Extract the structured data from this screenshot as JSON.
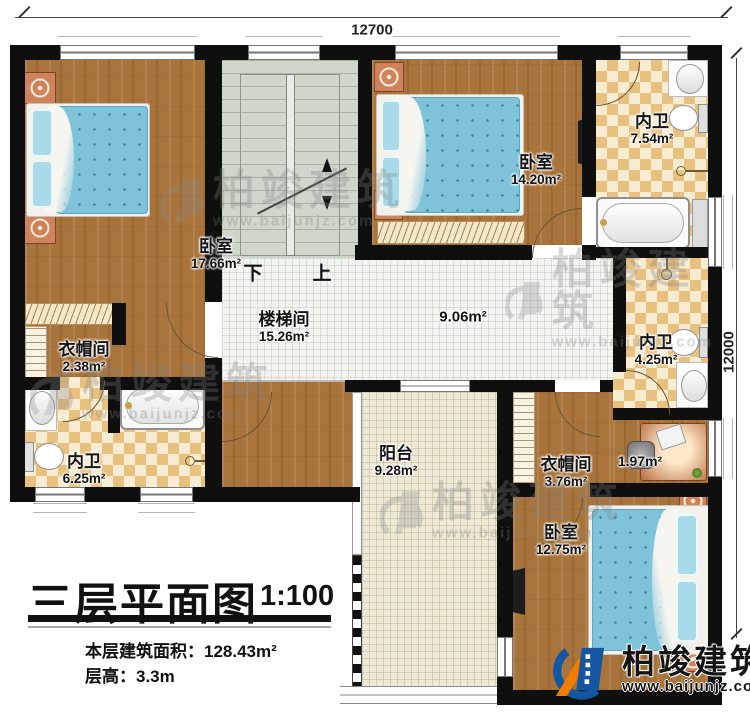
{
  "dimensions": {
    "width_top": "12700",
    "height_right": "12000"
  },
  "rooms": {
    "bedroom_top_left": {
      "name": "卧室",
      "area": "17.66m²"
    },
    "bedroom_top_middle": {
      "name": "卧室",
      "area": "14.20m²"
    },
    "bedroom_bottom_right": {
      "name": "卧室",
      "area": "12.75m²"
    },
    "bath_top_right": {
      "name": "内卫",
      "area": "7.54m²"
    },
    "bath_bottom_left": {
      "name": "内卫",
      "area": "6.25m²"
    },
    "bath_middle_right": {
      "name": "内卫",
      "area": "4.25m²"
    },
    "closet_left": {
      "name": "衣帽间",
      "area": "2.38m²"
    },
    "closet_right": {
      "name": "衣帽间",
      "area": "3.76m²"
    },
    "stair_hall": {
      "name": "楼梯间",
      "area": "15.26m²"
    },
    "corridor": {
      "area": "9.06m²"
    },
    "desk_nook": {
      "area": "1.97m²"
    },
    "balcony": {
      "name": "阳台",
      "area": "9.28m²"
    }
  },
  "stairs": {
    "down_label": "下",
    "up_label": "上"
  },
  "title_block": {
    "title": "三层平面图",
    "scale": "1:100",
    "floor_area": "本层建筑面积：128.43m²",
    "floor_height": "层高：3.3m"
  },
  "brand": {
    "name": "柏竣建筑",
    "url": "www.baijunjz.com"
  },
  "watermark": {
    "name": "柏竣建筑",
    "url": "www.baijunjz.com"
  },
  "colors": {
    "wall": "#0f0f0f",
    "wood": "#a9743b",
    "tile_dark": "#e9c17f",
    "tile_light": "#f8ecd2",
    "bed": "#7ec3d9",
    "stair": "#cfd6ca",
    "brand_blue": "#1456a0",
    "brand_orange": "#f07d00"
  }
}
